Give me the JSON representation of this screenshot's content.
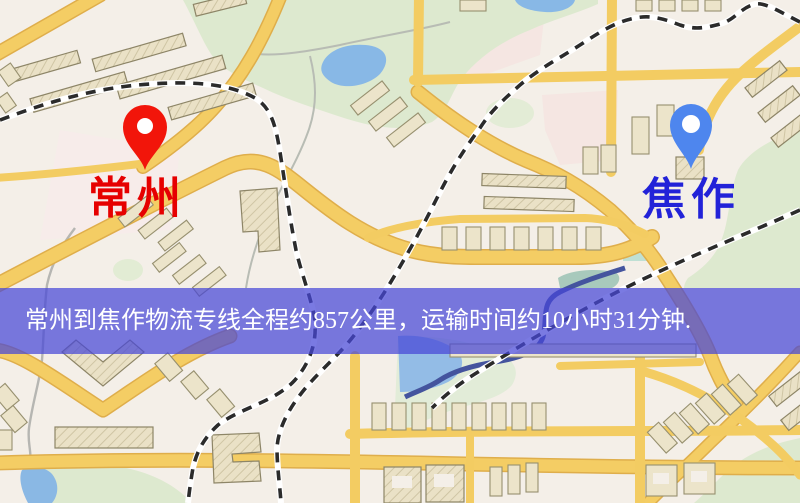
{
  "banner": {
    "text": "常州到焦作物流专线全程约857公里，运输时间约10小时31分钟."
  },
  "markers": {
    "origin": {
      "label": "常州",
      "pin_color": "#f2150a",
      "label_color": "#e60000"
    },
    "destination": {
      "label": "焦作",
      "pin_color": "#4e86ee",
      "label_color": "#2222d8"
    }
  },
  "map_colors": {
    "background": "#f4efe8",
    "road": "#f4cd64",
    "park": "#dde9cf",
    "water": "#8ab8e4",
    "railway": "#2b2b2b",
    "banner_background": "rgba(70,70,215,0.72)",
    "banner_text": "#ffffff"
  }
}
